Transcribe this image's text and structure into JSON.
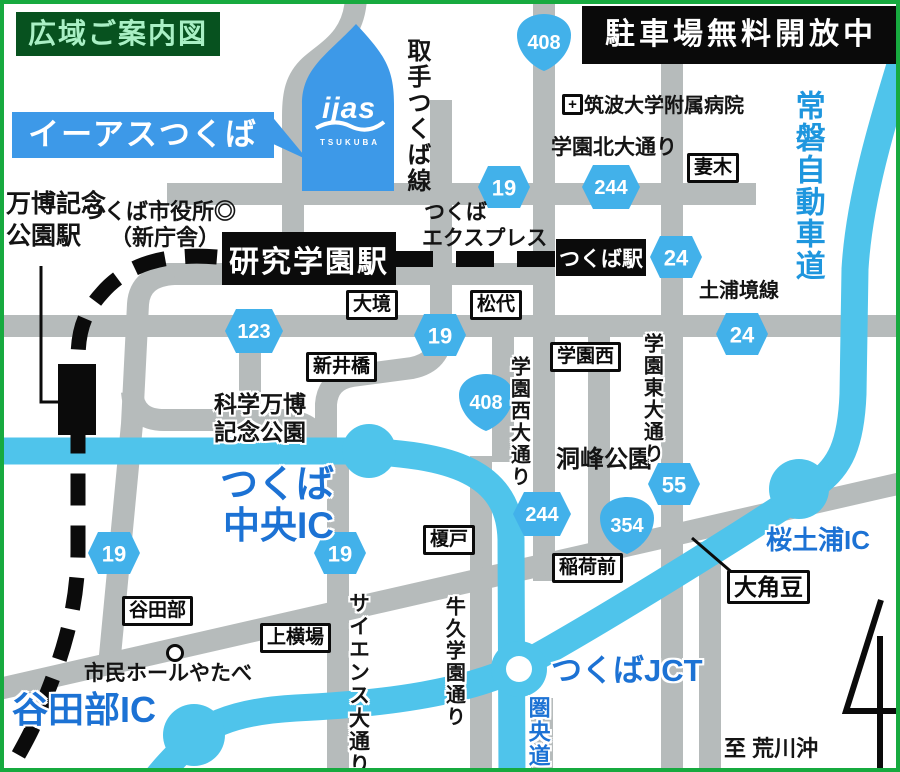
{
  "legend": {
    "title": "広域ご案内図",
    "notice": "駐車場無料開放中"
  },
  "mall": {
    "banner": "イーアスつくば",
    "logo": "ijas",
    "logo_sub": "TSUKUBA"
  },
  "railway": {
    "line_name_l1": "つくば",
    "line_name_l2": "エクスプレス",
    "kenkyu_gakuen_station": "研究学園駅",
    "tsukuba_station": "つくば駅",
    "banpaku_station_l1": "万博記念",
    "banpaku_station_l2": "公園駅"
  },
  "places": {
    "city_hall": "つくば市役所◎",
    "city_hall_sub": "（新庁舎）",
    "hospital": "筑波大学附属病院",
    "expo_park_l1": "科学万博",
    "expo_park_l2": "記念公園",
    "doho_park": "洞峰公園",
    "civic_hall": "市民ホールやたべ",
    "to_arakawaoki": "至 荒川沖",
    "big_numeral": "4"
  },
  "roads": {
    "toride_tsukuba_line": "取手つくば線",
    "joban_expressway": "常磐自動車道",
    "gakuen_kita_odori": "学園北大通り",
    "tsuchiura_sakai_line": "土浦境線",
    "gakuen_nishi_odori": "学園西大通り",
    "gakuen_higashi_odori": "学園東大通り",
    "science_odori": "サイエンス大通り",
    "ushiku_gakuen_dori": "牛久学園通り",
    "kenodo": "圏央道"
  },
  "interchanges": {
    "tsukuba_chuo_l1": "つくば",
    "tsukuba_chuo_l2": "中央IC",
    "yatabe_ic": "谷田部IC",
    "tsukuba_jct": "つくばJCT",
    "sakura_tsuchiura_ic": "桜土浦IC"
  },
  "intersections": {
    "tsumagi": "妻木",
    "ozakai": "大境",
    "matsushiro": "松代",
    "araibashi": "新井橋",
    "gakuen_nishi": "学園西",
    "enokido": "榎戸",
    "inarimae": "稲荷前",
    "sasagi": "大角豆",
    "yatabe": "谷田部",
    "kamiyokoba": "上横場"
  },
  "route_shields": {
    "r408_top": "408",
    "r408_mid": "408",
    "r354": "354",
    "r123": "123",
    "r244_top": "244",
    "r244_mid": "244",
    "r19_top": "19",
    "r19_center": "19",
    "r19_west": "19",
    "r19_science": "19",
    "r24_station": "24",
    "r24_east": "24",
    "r55": "55"
  },
  "colors": {
    "expressway": "#4FC4EB",
    "ordinary_road": "#B6BBBB",
    "shield_blue": "#42B1EA",
    "ic_text_blue": "#1C72D4",
    "border_green": "#17AA3F",
    "banner_blue": "#3D99E8",
    "title_bg_green": "#07521F",
    "title_text_green": "#A9F0C5",
    "expwy_text": "#1E96DE"
  }
}
